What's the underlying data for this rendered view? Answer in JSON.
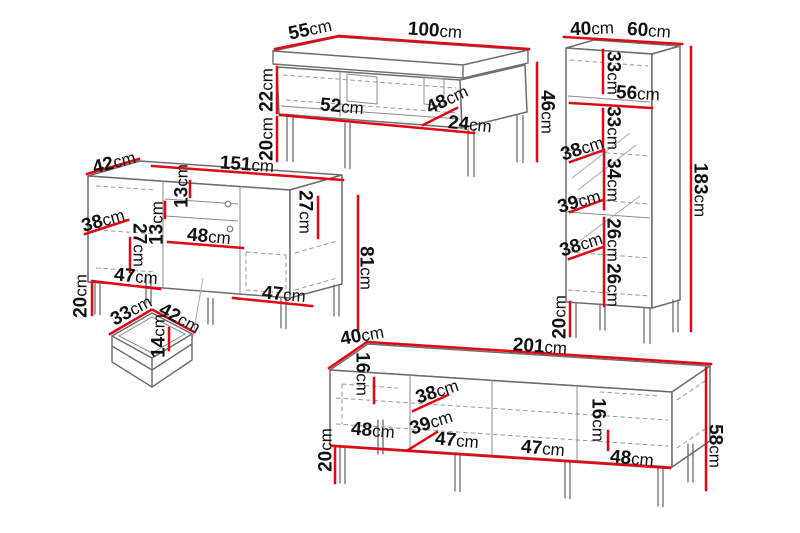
{
  "diagram": {
    "description": "Furniture set dimension drawing: coffee table, tall cabinet, sideboard with drawer, TV stand",
    "unit": "cm"
  },
  "colors": {
    "dimension": "#e30613",
    "outline": "#6d6d6d",
    "text": "#111111",
    "background": "#ffffff"
  },
  "pieces": {
    "coffee_table": {
      "name": "coffee-table",
      "dims": {
        "depth": "55cm",
        "width": "100cm",
        "body_height": "22cm",
        "leg_height": "20cm",
        "shelf_length": "52cm",
        "inner_width": "48cm",
        "niche_width": "24cm",
        "total_height": "46cm"
      }
    },
    "tall_cabinet": {
      "name": "tall-cabinet",
      "dims": {
        "depth": "40cm",
        "width": "60cm",
        "section_1": "33cm",
        "shelf_width": "56cm",
        "section_2": "33cm",
        "inner_depth_1": "38cm",
        "section_3": "34cm",
        "inner_depth_2": "39cm",
        "section_4": "26cm",
        "inner_depth_3": "38cm",
        "section_5": "26cm",
        "leg_height": "20cm",
        "total_height": "183cm"
      }
    },
    "sideboard": {
      "name": "sideboard",
      "dims": {
        "depth": "42cm",
        "width": "151cm",
        "door_width": "38cm",
        "inner_height_left": "27cm",
        "shelf_gap_1": "13cm",
        "shelf_gap_2": "13cm",
        "drawer_width": "48cm",
        "inner_height_right": "27cm",
        "compartment_left": "47cm",
        "compartment_right": "47cm",
        "leg_height": "20cm",
        "total_height": "81cm"
      }
    },
    "drawer": {
      "name": "drawer",
      "dims": {
        "width": "33cm",
        "depth": "42cm",
        "height": "14cm"
      }
    },
    "tv_stand": {
      "name": "tv-stand",
      "dims": {
        "depth": "40cm",
        "width": "201cm",
        "top_gap_left": "16cm",
        "door_width": "38cm",
        "compartment_1": "48cm",
        "inner_depth": "39cm",
        "compartment_2": "47cm",
        "compartment_3": "47cm",
        "top_gap_right": "16cm",
        "compartment_4": "48cm",
        "leg_height": "20cm",
        "total_height": "58cm"
      }
    }
  }
}
